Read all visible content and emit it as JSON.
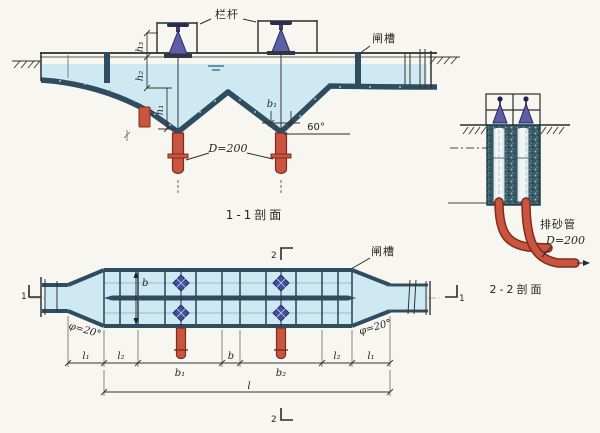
{
  "figure": {
    "kind": "hydraulic-desilting-basin-drawing",
    "colors": {
      "bg": "#f7f6f0",
      "water": "#cfe9f3",
      "wall": "#2e4d60",
      "wall_dark": "#1c3540",
      "pipe": "#c9543f",
      "pipe_dark": "#7e2d1c",
      "valve": "#5c5fa8",
      "valve_dark": "#27275c",
      "ink": "#2b2b2b"
    },
    "section1": {
      "caption": "1-1剖面",
      "railing_label": "栏杆",
      "gate_slot_label": "闸槽",
      "dim_h3": "h₃",
      "dim_h2": "h₂",
      "dim_h1": "h₁",
      "dim_b1": "b₁",
      "slope_angle": "60°",
      "pipe_diameter": "D=200"
    },
    "section2": {
      "caption": "2-2剖面",
      "sand_pipe_label": "排砂管",
      "pipe_diameter": "D=200"
    },
    "plan": {
      "gate_slot_label": "闸槽",
      "angle_left": "φ=20°",
      "angle_right": "φ=20°",
      "dim_width": "b",
      "dim_l1_left": "l₁",
      "dim_l2_left": "l₂",
      "dim_b1": "b₁",
      "dim_b_gap": "b",
      "dim_b2": "b₂",
      "dim_l2_right": "l₂",
      "dim_l1_right": "l₁",
      "dim_l_total": "l",
      "marker_1": "1",
      "marker_2": "2"
    }
  }
}
